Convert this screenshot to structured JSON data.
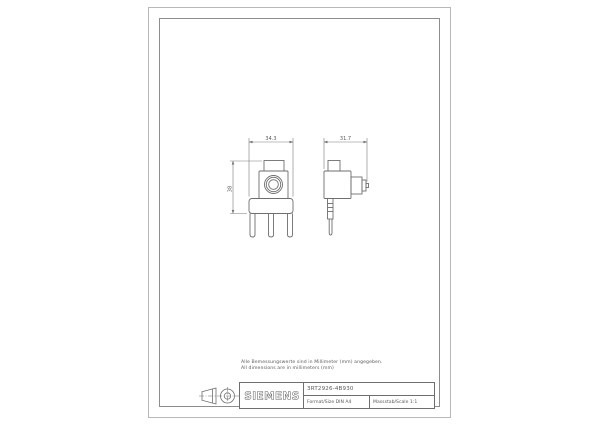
{
  "sheet": {
    "notes": {
      "line1": "Alle Bemessungswerte sind in Millimeter (mm) angegeben.",
      "line2": "All dimensions are in millimeters (mm)"
    },
    "dimensions": {
      "front_width": "34.3",
      "side_width": "31.7",
      "height": "38"
    },
    "title_block": {
      "brand": "SIEMENS",
      "drawing_number": "3RT2926-4B930",
      "format": "Format/Size DIN A4",
      "scale": "Massstab/Scale 1:1"
    },
    "symbols": {
      "projection": "first-angle projection"
    }
  },
  "colors": {
    "line": "#6e6e6e",
    "text": "#5a5a5a",
    "border_outer": "#b8b8b8",
    "border_inner": "#8d8d8d"
  }
}
